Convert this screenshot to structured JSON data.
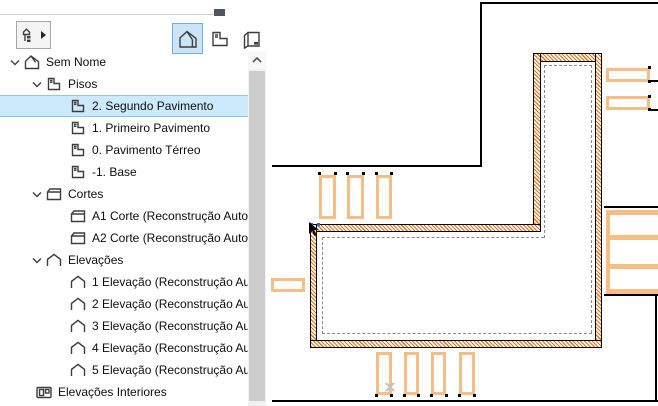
{
  "colors": {
    "selection_blue_bg": "#cde9fc",
    "selection_blue_border": "#8ec7ef",
    "button_blue_bg": "#cbe4f8",
    "button_blue_border": "#70aede",
    "wall_hatch_orange": "#e06f10",
    "element_orange": "#f7bd82",
    "reference_line_gray": "#8a8a8a",
    "scroll_thumb_gray": "#cdcdcd"
  },
  "navigator": {
    "toolbar": {
      "tree_selector": {
        "icon": "project-tree-icon",
        "dropdown_icon": "right-arrow-icon"
      },
      "view_modes": [
        {
          "id": "model",
          "icon": "house-icon",
          "selected": true
        },
        {
          "id": "story",
          "icon": "story-icon",
          "selected": false
        },
        {
          "id": "layout",
          "icon": "layout-book-icon",
          "selected": false
        }
      ]
    },
    "tree": [
      {
        "id": "sem-nome",
        "label": "Sem Nome",
        "icon": "house",
        "level": 0,
        "expanded": true
      },
      {
        "id": "pisos",
        "label": "Pisos",
        "icon": "story",
        "level": 1,
        "expanded": true
      },
      {
        "id": "piso-2",
        "label": "2. Segundo Pavimento",
        "icon": "story",
        "level": 2,
        "selected": true
      },
      {
        "id": "piso-1",
        "label": "1. Primeiro Pavimento",
        "icon": "story",
        "level": 2
      },
      {
        "id": "piso-0",
        "label": "0. Pavimento Térreo",
        "icon": "story",
        "level": 2
      },
      {
        "id": "piso-m1",
        "label": "-1. Base",
        "icon": "story",
        "level": 2
      },
      {
        "id": "cortes",
        "label": "Cortes",
        "icon": "section",
        "level": 1,
        "expanded": true
      },
      {
        "id": "corte-a1",
        "label": "A1 Corte (Reconstrução Automática",
        "icon": "section",
        "level": 2
      },
      {
        "id": "corte-a2",
        "label": "A2 Corte (Reconstrução Automática",
        "icon": "section",
        "level": 2
      },
      {
        "id": "elevacoes",
        "label": "Elevações",
        "icon": "elevation",
        "level": 1,
        "expanded": true
      },
      {
        "id": "elevacao-1",
        "label": "1 Elevação (Reconstrução Automáti",
        "icon": "elevation",
        "level": 2
      },
      {
        "id": "elevacao-2",
        "label": "2 Elevação (Reconstrução Automáti",
        "icon": "elevation",
        "level": 2
      },
      {
        "id": "elevacao-3",
        "label": "3 Elevação (Reconstrução Automáti",
        "icon": "elevation",
        "level": 2
      },
      {
        "id": "elevacao-4",
        "label": "4 Elevação (Reconstrução Automáti",
        "icon": "elevation",
        "level": 2
      },
      {
        "id": "elevacao-5",
        "label": "5 Elevação (Reconstrução Automáti",
        "icon": "elevation",
        "level": 2
      },
      {
        "id": "elevacoes-interiores",
        "label": "Elevações Interiores",
        "icon": "interior-elevation",
        "level": 1,
        "no_chevron_indent": true
      }
    ]
  },
  "drawing": {
    "walls": [
      {
        "x": 533,
        "y": 53,
        "w": 69,
        "h": 9
      },
      {
        "x": 533,
        "y": 53,
        "w": 8,
        "h": 179
      },
      {
        "x": 595,
        "y": 53,
        "w": 7,
        "h": 295
      },
      {
        "x": 310,
        "y": 224,
        "w": 231,
        "h": 8
      },
      {
        "x": 310,
        "y": 224,
        "w": 7,
        "h": 124
      },
      {
        "x": 310,
        "y": 340,
        "w": 292,
        "h": 8
      }
    ],
    "reference_lines": [
      {
        "o": "h",
        "x": 322,
        "y": 237,
        "len": 222
      },
      {
        "o": "v",
        "x": 544,
        "y": 65,
        "len": 173
      },
      {
        "o": "h",
        "x": 544,
        "y": 65,
        "len": 48
      },
      {
        "o": "v",
        "x": 591,
        "y": 65,
        "len": 268
      },
      {
        "o": "h",
        "x": 322,
        "y": 333,
        "len": 270
      },
      {
        "o": "v",
        "x": 322,
        "y": 237,
        "len": 97
      }
    ],
    "orange_rects": [
      {
        "x": 319,
        "y": 175,
        "w": 17,
        "h": 44
      },
      {
        "x": 347,
        "y": 175,
        "w": 17,
        "h": 44
      },
      {
        "x": 376,
        "y": 175,
        "w": 16,
        "h": 44
      },
      {
        "x": 271,
        "y": 278,
        "w": 34,
        "h": 14
      },
      {
        "x": 606,
        "y": 68,
        "w": 44,
        "h": 14
      },
      {
        "x": 606,
        "y": 96,
        "w": 44,
        "h": 14
      },
      {
        "x": 376,
        "y": 352,
        "w": 16,
        "h": 43
      },
      {
        "x": 404,
        "y": 352,
        "w": 15,
        "h": 43
      },
      {
        "x": 431,
        "y": 352,
        "w": 15,
        "h": 43
      },
      {
        "x": 459,
        "y": 352,
        "w": 16,
        "h": 43
      }
    ],
    "black_lines": [
      {
        "x": 480,
        "y": 2,
        "w": 178,
        "h": 2
      },
      {
        "x": 480,
        "y": 2,
        "w": 2,
        "h": 165
      },
      {
        "x": 272,
        "y": 165,
        "w": 210,
        "h": 2
      },
      {
        "x": 604,
        "y": 206,
        "w": 54,
        "h": 2
      },
      {
        "x": 604,
        "y": 294,
        "w": 54,
        "h": 2
      },
      {
        "x": 655,
        "y": 294,
        "w": 2,
        "h": 108
      },
      {
        "x": 272,
        "y": 400,
        "w": 386,
        "h": 2
      }
    ],
    "stack": {
      "x": 606,
      "y": 210,
      "w": 52,
      "h": 84,
      "bars": [
        20,
        49
      ]
    },
    "hotspot_dots": [
      [
        318,
        172
      ],
      [
        334,
        172
      ],
      [
        346,
        172
      ],
      [
        362,
        172
      ],
      [
        375,
        172
      ],
      [
        390,
        172
      ],
      [
        375,
        394
      ],
      [
        390,
        394
      ],
      [
        403,
        394
      ],
      [
        417,
        394
      ],
      [
        430,
        394
      ],
      [
        445,
        394
      ],
      [
        458,
        394
      ],
      [
        473,
        394
      ],
      [
        648,
        66
      ],
      [
        648,
        80
      ],
      [
        648,
        95
      ],
      [
        648,
        108
      ]
    ],
    "blue_dots": [
      [
        310,
        223
      ],
      [
        317,
        223
      ]
    ],
    "ticks": [
      {
        "x": 651,
        "y": 80,
        "w": 7
      },
      {
        "x": 651,
        "y": 109,
        "w": 7
      }
    ],
    "snap_cross": {
      "x": 384,
      "y": 381
    },
    "cursor": {
      "x": 306,
      "y": 221
    }
  }
}
